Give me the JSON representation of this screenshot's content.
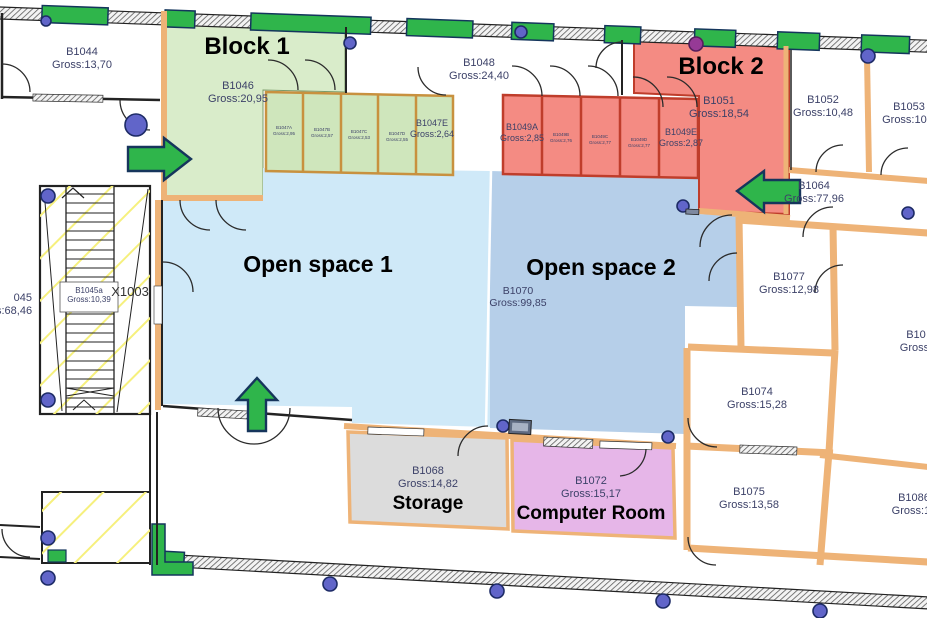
{
  "colors": {
    "wall-tan": "#eeb377",
    "block1": "#d9ecca",
    "block1-room": "#cfe6bc",
    "room-green-border": "#c8913f",
    "block2": "#f48b83",
    "block2-border": "#bf3d2b",
    "open1": "#cfe9f8",
    "open2": "#b6cfe9",
    "storage": "#dcdcdc",
    "computer": "#e6b6e8",
    "green": "#2fb54b",
    "arrow-outline": "#16355c",
    "dot-blue": "#6165c9",
    "dot-purple": "#963a96",
    "label": "#3c4168"
  },
  "zones": {
    "block1": {
      "title": "Block 1"
    },
    "block2": {
      "title": "Block 2"
    },
    "open1": {
      "title": "Open space 1"
    },
    "open2": {
      "title": "Open space 2"
    }
  },
  "rooms": {
    "b1044": {
      "id": "B1044",
      "gross": "Gross:13,70"
    },
    "b1046": {
      "id": "B1046",
      "gross": "Gross:20,95"
    },
    "b1047a": {
      "id": "B1047A",
      "gross": "Gross:2,95"
    },
    "b1047b": {
      "id": "B1047B",
      "gross": "Gross:2,57"
    },
    "b1047c": {
      "id": "B1047C",
      "gross": "Gross:2,53"
    },
    "b1047d": {
      "id": "B1047D",
      "gross": "Gross:2,55"
    },
    "b1047e": {
      "id": "B1047E",
      "gross": "Gross:2,64"
    },
    "b1048": {
      "id": "B1048",
      "gross": "Gross:24,40"
    },
    "b1049a": {
      "id": "B1049A",
      "gross": "Gross:2,85"
    },
    "b1049b": {
      "id": "B1049B",
      "gross": "Gross:2,76"
    },
    "b1049c": {
      "id": "B1049C",
      "gross": "Gross:2,77"
    },
    "b1049d": {
      "id": "B1049D",
      "gross": "Gross:2,77"
    },
    "b1049e": {
      "id": "B1049E",
      "gross": "Gross:2,87"
    },
    "b1051": {
      "id": "B1051",
      "gross": "Gross:18,54"
    },
    "b1052": {
      "id": "B1052",
      "gross": "Gross:10,48"
    },
    "b1053": {
      "id": "B1053",
      "gross": "Gross:10,4"
    },
    "b1064": {
      "id": "B1064",
      "gross": "Gross:77,96"
    },
    "b1070": {
      "id": "B1070",
      "gross": "Gross:99,85"
    },
    "b1068": {
      "id": "B1068",
      "gross": "Gross:14,82",
      "name": "Storage"
    },
    "b1072": {
      "id": "B1072",
      "gross": "Gross:15,17",
      "name": "Computer Room"
    },
    "b1074": {
      "id": "B1074",
      "gross": "Gross:15,28"
    },
    "b1075": {
      "id": "B1075",
      "gross": "Gross:13,58"
    },
    "b1077": {
      "id": "B1077",
      "gross": "Gross:12,98"
    },
    "b1086": {
      "id": "B1086",
      "gross": "Gross:19"
    },
    "b1045a": {
      "id": "B1045a",
      "gross": "Gross:10,39"
    },
    "b1045_edge": {
      "id": "045",
      "gross": "s:68,46"
    },
    "b10_edge": {
      "id": "B10",
      "gross": "Gross:"
    },
    "x1003": {
      "id": "X1003"
    }
  }
}
